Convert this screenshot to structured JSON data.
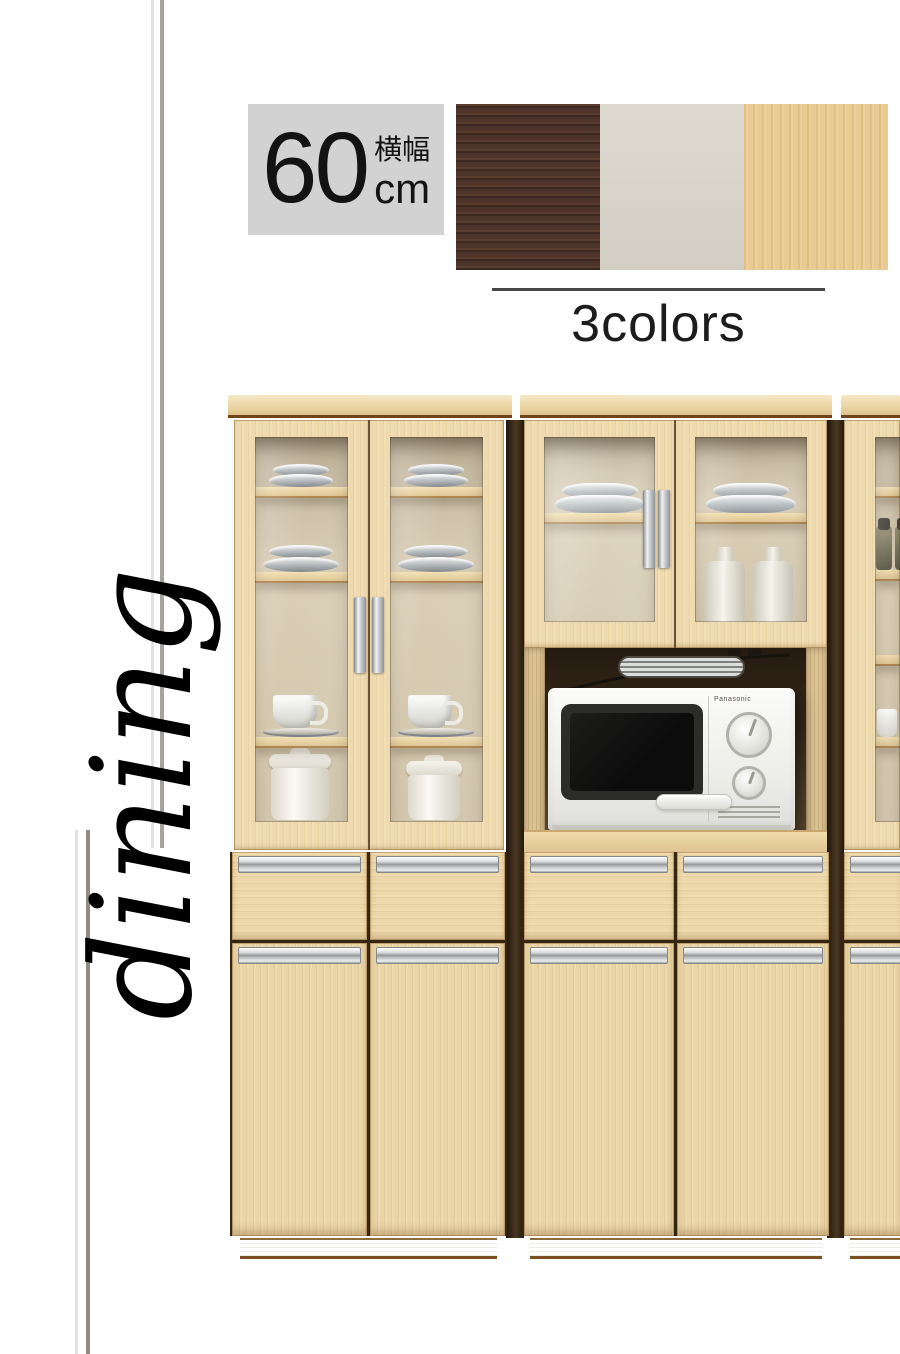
{
  "badge": {
    "value": "60",
    "unit": "cm",
    "label": "横幅"
  },
  "colors": {
    "label": "3colors",
    "swatches": [
      {
        "name": "dark-brown",
        "hex": "#4c342a"
      },
      {
        "name": "white",
        "hex": "#d9d5ca"
      },
      {
        "name": "natural",
        "hex": "#e8ca92"
      }
    ]
  },
  "side_label": "dining",
  "photo": {
    "microwave_brand": "Panasonic",
    "wood_hex": "#ead5a6",
    "contents": [
      "plates",
      "teacups",
      "canisters",
      "bowls",
      "bottles",
      "spice-jars",
      "mugs",
      "microwave"
    ]
  }
}
